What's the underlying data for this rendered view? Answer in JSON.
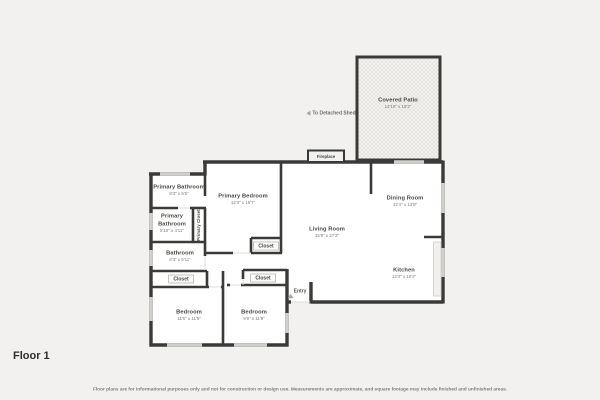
{
  "page": {
    "floor_label": "Floor 1",
    "disclaimer": "Floor plans are for informational purposes only and not for construction or design use. Measurements are approximate, and square footage may include finished and unfinished areas."
  },
  "rooms": {
    "covered_patio": {
      "name": "Covered Patio",
      "dims": "14'10\" x 18'2\""
    },
    "living_room": {
      "name": "Living Room",
      "dims": "15'8\" x 27'2\""
    },
    "dining_room": {
      "name": "Dining Room",
      "dims": "12'4\" x 13'8\""
    },
    "kitchen": {
      "name": "Kitchen",
      "dims": "12'4\" x 10'2\""
    },
    "primary_bedroom": {
      "name": "Primary Bedroom",
      "dims": "12'3\" x 15'7\""
    },
    "primary_bathroom_upper": {
      "name": "Primary Bathroom",
      "dims": "8'3\" x 5'5\""
    },
    "primary_bathroom_lower": {
      "name": "Primary Bathroom",
      "dims": "5'10\" x 4'11\""
    },
    "bathroom": {
      "name": "Bathroom",
      "dims": "8'3\" x 5'11\""
    },
    "bedroom_left": {
      "name": "Bedroom",
      "dims": "11'6\" x 11'9\""
    },
    "bedroom_right": {
      "name": "Bedroom",
      "dims": "9'9\" x 11'9\""
    },
    "primary_closet": {
      "name": "Primary Closet"
    }
  },
  "labels": {
    "closet": "Closet",
    "fireplace": "Fireplace",
    "entry": "Entry",
    "to_detached_shed": "To Detached Shed"
  },
  "colors": {
    "wall": "#3a3a38",
    "background": "#f2f1ef",
    "room_fill": "#ffffff",
    "window": "#cfcfcb",
    "patio_hatch": "#e0dfdb"
  }
}
